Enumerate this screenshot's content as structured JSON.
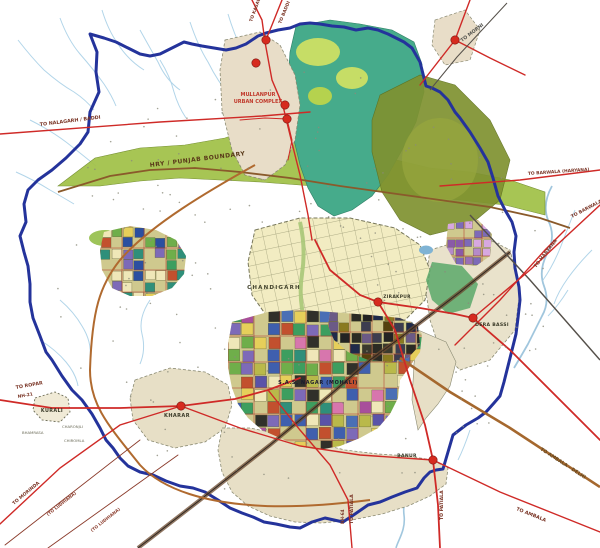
{
  "map": {
    "name": "chandigarh-region-master-plan",
    "boundary_label": {
      "text": "HRY / PUNJAB BOUNDARY",
      "x": 150,
      "y": 167,
      "rot": -7,
      "color": "#5a3a1a",
      "size": 6
    },
    "urban_complex_label": {
      "line1": "MULLANPUR",
      "line2": "URBAN COMPLEX",
      "x": 258,
      "y1": 96,
      "y2": 103,
      "color": "#c0392b",
      "size": 5
    },
    "towns": [
      {
        "id": "chandigarh",
        "label": "CHANDIGARH",
        "x": 274,
        "y": 289,
        "size": 5.5,
        "ls": 1.2,
        "color": "#44442e"
      },
      {
        "id": "mohali",
        "label": "S.A.S. NAGAR (MOHALI)",
        "x": 318,
        "y": 384,
        "size": 5,
        "ls": 0.6,
        "color": "#1b1b2e"
      },
      {
        "id": "kharar",
        "label": "KHARAR",
        "x": 177,
        "y": 417,
        "size": 5,
        "ls": 0.4,
        "color": "#3a3a28"
      },
      {
        "id": "kurali",
        "label": "KURALI",
        "x": 52,
        "y": 412,
        "size": 4.8,
        "ls": 0.4,
        "color": "#3a3a28"
      },
      {
        "id": "dera-bassi",
        "label": "DERA BASSI",
        "x": 492,
        "y": 326,
        "size": 4.6,
        "ls": 0.3,
        "color": "#3a3a28"
      },
      {
        "id": "zirakpur",
        "label": "ZIRAKPUR",
        "x": 397,
        "y": 298,
        "size": 4.4,
        "ls": 0.3,
        "color": "#3a3a28"
      },
      {
        "id": "banur",
        "label": "BANUR",
        "x": 407,
        "y": 457,
        "size": 4.6,
        "ls": 0.3,
        "color": "#3a3a28"
      }
    ],
    "town_dots": [
      {
        "x": 266,
        "y": 40
      },
      {
        "x": 256,
        "y": 63
      },
      {
        "x": 285,
        "y": 105
      },
      {
        "x": 287,
        "y": 119
      },
      {
        "x": 455,
        "y": 40
      },
      {
        "x": 181,
        "y": 406
      },
      {
        "x": 378,
        "y": 302
      },
      {
        "x": 473,
        "y": 318
      },
      {
        "x": 433,
        "y": 460
      }
    ],
    "road_labels": [
      {
        "text": "TO NALAGARH / BADDI",
        "x": 40,
        "y": 126,
        "rot": -7,
        "size": 4.8,
        "color": "#7a3526"
      },
      {
        "text": "TO ROPAR",
        "x": 16,
        "y": 389,
        "rot": -10,
        "size": 4.8,
        "color": "#7a3526"
      },
      {
        "text": "NH-21",
        "x": 18,
        "y": 398,
        "rot": -10,
        "size": 4.4,
        "color": "#7a3526"
      },
      {
        "text": "TO MORINDA",
        "x": 14,
        "y": 505,
        "rot": -40,
        "size": 4.6,
        "color": "#7a3526"
      },
      {
        "text": "(TO LUDHIANA)",
        "x": 48,
        "y": 516,
        "rot": -38,
        "size": 4.2,
        "color": "#8a3a2a"
      },
      {
        "text": "(TO LUDHIANA)",
        "x": 92,
        "y": 532,
        "rot": -38,
        "size": 4.2,
        "color": "#8a3a2a"
      },
      {
        "text": "NH-64",
        "x": 344,
        "y": 524,
        "rot": -90,
        "size": 4.2,
        "color": "#7a3526"
      },
      {
        "text": "TO PATIALA",
        "x": 353,
        "y": 524,
        "rot": -90,
        "size": 4.6,
        "color": "#7a3526"
      },
      {
        "text": "TO PATIALA",
        "x": 443,
        "y": 520,
        "rot": -90,
        "size": 4.6,
        "color": "#7a3526"
      },
      {
        "text": "TO AMBALA",
        "x": 516,
        "y": 510,
        "rot": 22,
        "size": 4.8,
        "color": "#7a3526"
      },
      {
        "text": "TO AMBALA - DELHI",
        "x": 540,
        "y": 450,
        "rot": 33,
        "size": 4.8,
        "color": "#6a4a20"
      },
      {
        "text": "TO HARYANA",
        "x": 536,
        "y": 268,
        "rot": -52,
        "size": 4.8,
        "color": "#7a3526"
      },
      {
        "text": "TO BARWALA",
        "x": 572,
        "y": 218,
        "rot": -28,
        "size": 4.6,
        "color": "#7a3526"
      },
      {
        "text": "TO BARWALA (HARYANA)",
        "x": 528,
        "y": 175,
        "rot": -4,
        "size": 4.4,
        "color": "#7a3526"
      },
      {
        "text": "TO MORNI",
        "x": 462,
        "y": 42,
        "rot": -37,
        "size": 4.8,
        "color": "#555550"
      },
      {
        "text": "TO BADDI",
        "x": 281,
        "y": 24,
        "rot": -68,
        "size": 4.4,
        "color": "#7a3526"
      },
      {
        "text": "TO KASAULI",
        "x": 252,
        "y": 22,
        "rot": -70,
        "size": 4.4,
        "color": "#7a3526"
      }
    ],
    "village_labels": [
      {
        "text": "BHAMRASA",
        "x": 22,
        "y": 434
      },
      {
        "text": "CHARONJLI",
        "x": 62,
        "y": 428
      },
      {
        "text": "CHIROMLA",
        "x": 64,
        "y": 442
      }
    ],
    "colors": {
      "planning_boundary": "#24339b",
      "state_boundary": "#8a5a2b",
      "road_red": "#cf2a27",
      "highway_brown": "#a5682e",
      "railway": "#4a3b2f",
      "water": "#a9cfe3",
      "greenbelt": "#a3c24b",
      "forest_teal": "#46ab8b",
      "forest_olive": "#7f9230",
      "chandigarh_grid": "#f2ecc2",
      "lpa_beige": "#e7dfc6",
      "town_dot": "#d62b1f"
    }
  }
}
